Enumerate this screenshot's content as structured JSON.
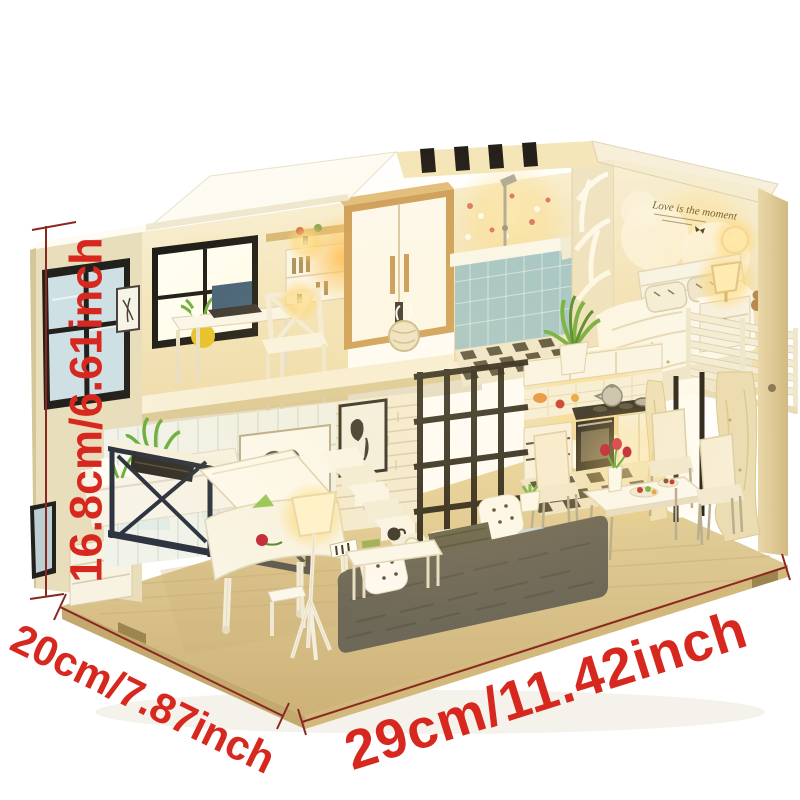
{
  "annotations": {
    "height_label": "16.8cm/6.61inch",
    "depth_label": "20cm/7.87inch",
    "width_label": "29cm/11.42inch"
  },
  "bedroom": {
    "wall_decal": "Love is the moment"
  },
  "palette": {
    "background": "#ffffff",
    "annotation_red": "#d7281f",
    "measure_line": "#8a2820",
    "wood": "#e0c68c",
    "wood_dark": "#bfa262",
    "cream_wall": "#f2e6c2",
    "warm_glow": "#ffd878",
    "white_furniture": "#fbf7ec",
    "sofa_gray": "#6e6858",
    "grid_black": "#241f16",
    "navy_railing": "#2e3440",
    "tub_blue": "#a3c6cb",
    "plant_green": "#6fae3f",
    "rose_red": "#c22838"
  }
}
